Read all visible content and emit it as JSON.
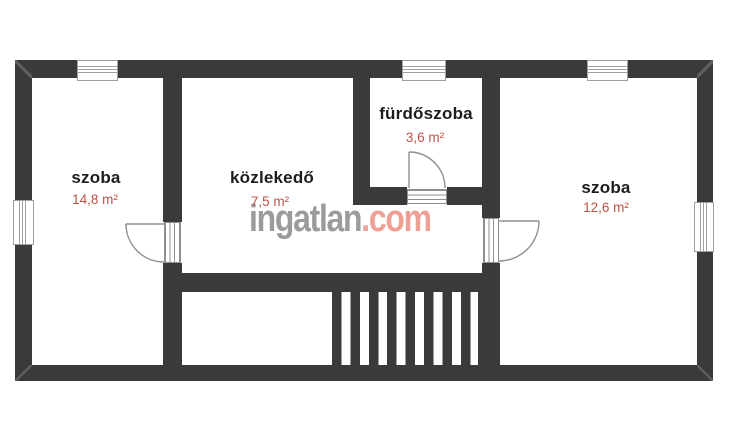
{
  "watermark": {
    "brand": "ingatlan",
    "suffix": ".com"
  },
  "rooms": [
    {
      "label": "szoba",
      "area": "14,8 m²"
    },
    {
      "label": "közlekedő",
      "area": "7,5 m²"
    },
    {
      "label": "fürdőszoba",
      "area": "3,6 m²"
    },
    {
      "label": "szoba",
      "area": "12,6 m²"
    }
  ],
  "colors": {
    "wall": "#3a3a3a",
    "room_label": "#1d1d1d",
    "area_label": "#bf5244",
    "watermark_brand": "#9b9b9b",
    "watermark_suffix": "#eda093",
    "door_window_line": "#8f8f8f"
  }
}
